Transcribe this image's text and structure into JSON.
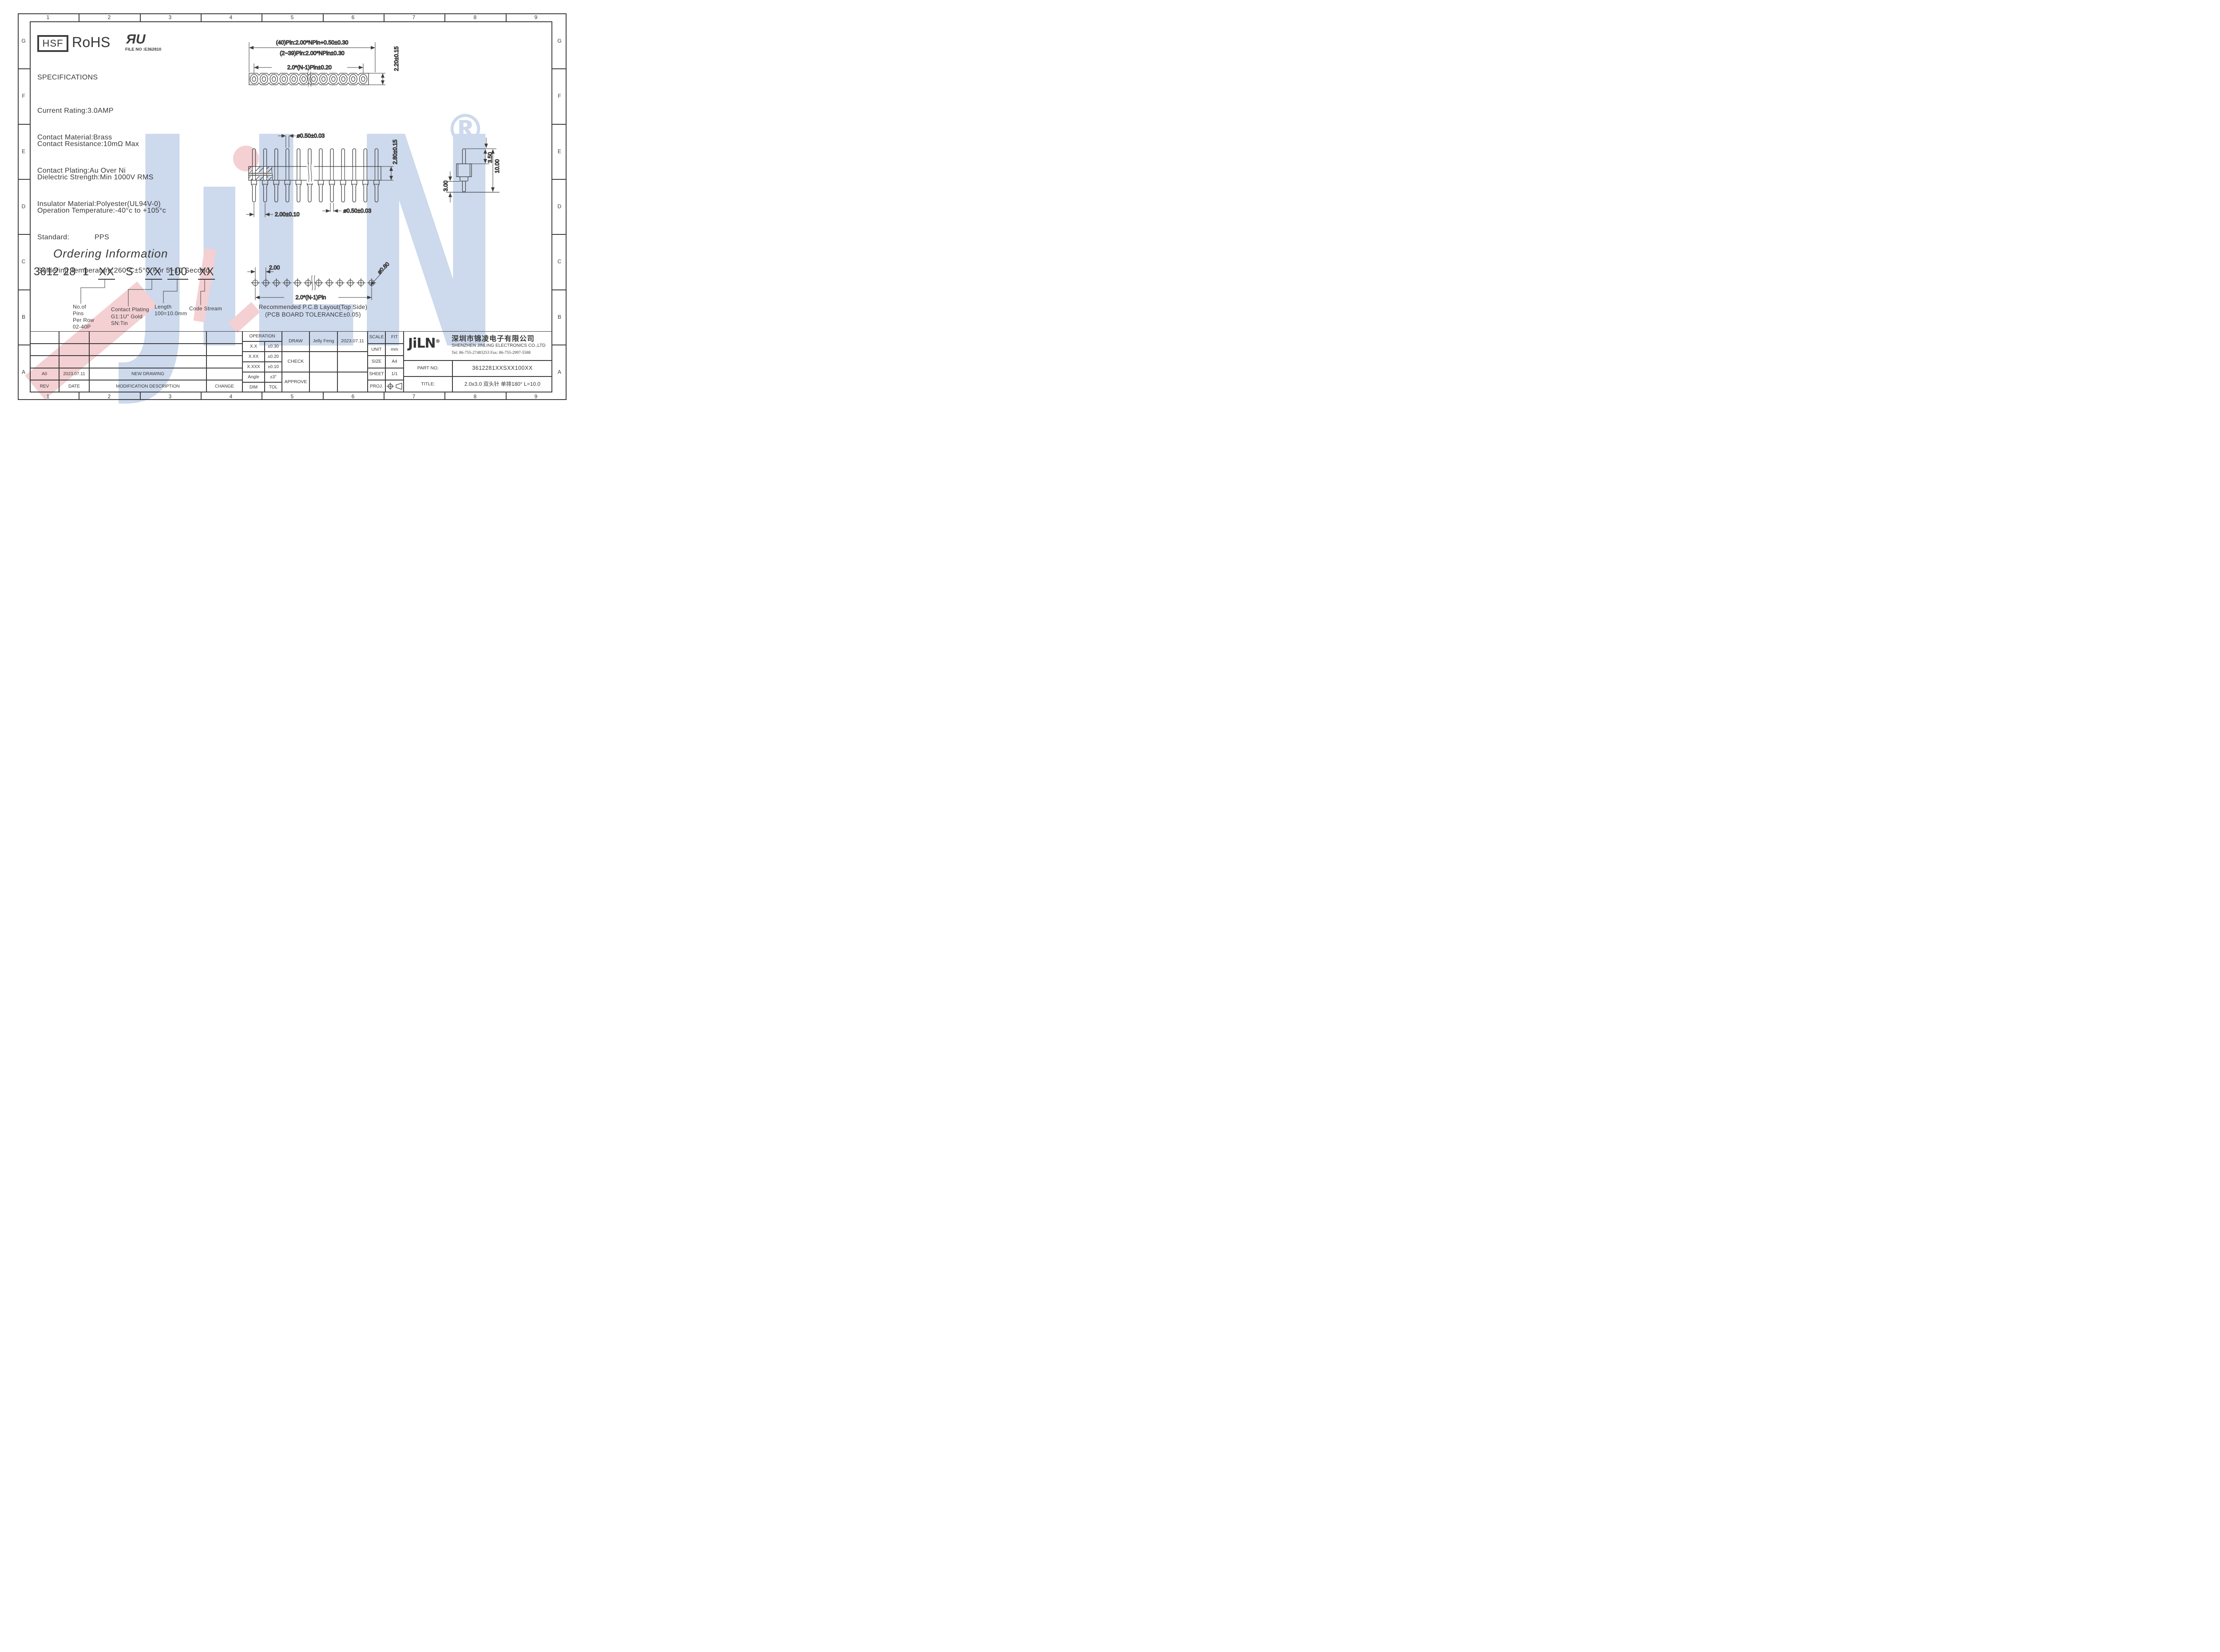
{
  "border": {
    "cols": [
      "1",
      "2",
      "3",
      "4",
      "5",
      "6",
      "7",
      "8",
      "9"
    ],
    "rows": [
      "G",
      "F",
      "E",
      "D",
      "C",
      "B",
      "A"
    ]
  },
  "certs": {
    "hsf": "HSF",
    "rohs": "RoHS",
    "ul_mark": "ЯU",
    "ul_file": "FILE NO :E362810"
  },
  "specs": {
    "title": "SPECIFICATIONS",
    "l1": "Current Rating:3.0AMP",
    "l2": "Contact Resistance:10mΩ Max",
    "l3": "Dielectric Strength:Min 1000V RMS",
    "l4": "Operation Temperature:-40°c to +105°c",
    "m1": "Contact Material:Brass",
    "m2": "Contact Plating:Au Over Ni",
    "m3": "Insulator Material:Polyester(UL94V-0)",
    "m4": "Standard:            PPS",
    "m5": "Soldering Temperature:260°C±5°C For 5~10 Second"
  },
  "top_view": {
    "dim_overall_40": "(40)Pin:2.00*NPin+0.50±0.30",
    "dim_overall_239": "(2~39)Pin:2.00*NPin±0.30",
    "dim_span": "2.0*(N-1)Pin±0.20",
    "dim_height": "2.20±0.15"
  },
  "side_view": {
    "dim_pin_dia_top": "ø0.50±0.03",
    "dim_body_height": "2.80±0.15",
    "dim_pitch": "2.00±0.10",
    "dim_pin_dia_bottom": "ø0.50±0.03"
  },
  "single_pin": {
    "dim_top_len": "3.50",
    "dim_total_len": "10.00",
    "dim_bottom_len": "3.00"
  },
  "ordering": {
    "title": "Ordering Information",
    "code": {
      "p1": "3612",
      "p2": "28",
      "p3": "1",
      "p4": "XX",
      "p5": "S",
      "p6": "XX",
      "p7": "100",
      "p8": "XX"
    },
    "pins_label": {
      "l1": "No.of",
      "l2": "Pins",
      "l3": "Per Row",
      "l4": "02-40P"
    },
    "plating_label": {
      "l1": "Contact Plating",
      "l2": "G1:1U\" Gold",
      "l3": "SN:Tin"
    },
    "length_label": {
      "l1": "Length",
      "l2": "100=10.0mm"
    },
    "stream_label": "Code Stream"
  },
  "pcb": {
    "dim_pitch": "2.00",
    "dim_hole_dia": "ø0.80",
    "dim_span": "2.0*(N-1)Pin",
    "caption1": "Recommended P.C.B Layout(Top Side)",
    "caption2": "(PCB BOARD TOLERANCE±0.05)"
  },
  "revisions": {
    "h_rev": "REV",
    "h_date": "DATE",
    "h_desc": "MODIFICATION DESCRIPTION",
    "h_change": "CHANGE",
    "r1_rev": "A0",
    "r1_date": "2023.07.11",
    "r1_desc": "NEW DRAWING",
    "r1_change": ""
  },
  "tolerances": {
    "title": "OPERATION",
    "r1c1": "X.X",
    "r1c2": "±0.30",
    "r2c1": "X.XX",
    "r2c2": "±0.20",
    "r3c1": "X.XXX",
    "r3c2": "±0.10",
    "r4c1": "Angle",
    "r4c2": "±3°",
    "r5c1": "DIM",
    "r5c2": "TOL"
  },
  "signoff": {
    "draw": "DRAW",
    "draw_name": "Jelly Feng",
    "draw_date": "2023.07.11",
    "check": "CHECK",
    "approve": "APPROVE"
  },
  "info": {
    "scale": "SCALE",
    "scale_v": "FIT",
    "unit": "UNIT",
    "unit_v": "mm",
    "size": "SIZE",
    "size_v": "A4",
    "sheet": "SHEET",
    "sheet_v": "1/1",
    "proj": "PROJ."
  },
  "company": {
    "logo": "JiLN",
    "reg": "®",
    "name_cn": "深圳市锦凌电子有限公司",
    "name_en": "SHENZHEN JINLING ELECTRONICS CO.,LTD",
    "tel": "Tel: 86-755-27483253  Fax: 86-755-2997-5588",
    "part_label": "PART NO.",
    "part_no": "3612281XXSXX100XX",
    "title_label": "TITLE:",
    "title_value": "2.0x3.0 双头针 单排180°  L=10.0"
  },
  "watermark": {
    "j": "J",
    "i": "ı",
    "l": "L",
    "n": "N",
    "reg": "®"
  }
}
